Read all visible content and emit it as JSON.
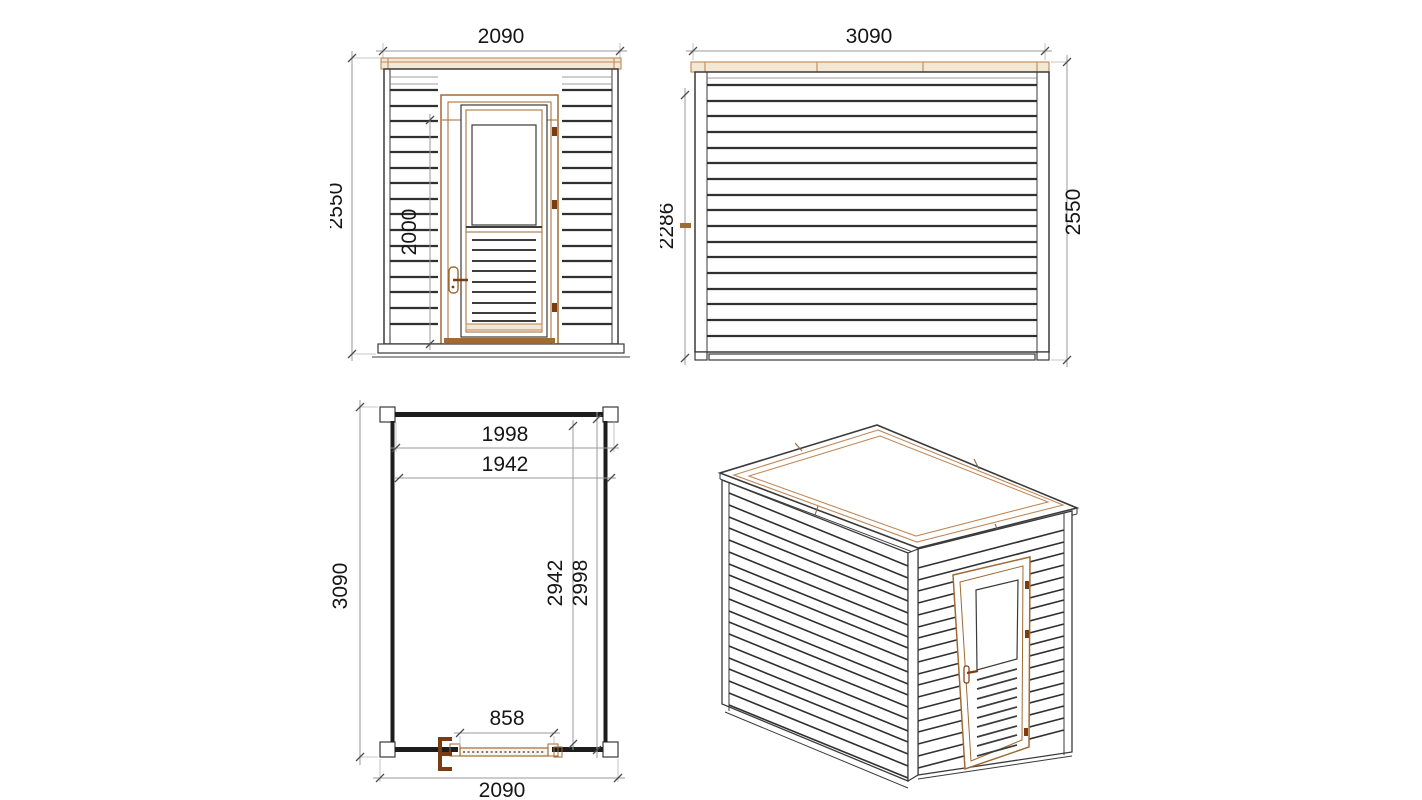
{
  "colors": {
    "line": "#3a3a3a",
    "dimension_line": "#9a9a9a",
    "label_text": "#161616",
    "wood_fill": "#f3e8d4",
    "wood_outline": "#c0895a",
    "door_frame": "#a06a33",
    "hinge": "#7a3c10",
    "background": "#ffffff"
  },
  "views": {
    "front": {
      "dims": {
        "width": "2090",
        "height": "2550",
        "door_height": "2000"
      }
    },
    "side": {
      "dims": {
        "width": "3090",
        "wall_height": "2286",
        "height": "2550"
      }
    },
    "plan": {
      "dims": {
        "inner_width_a": "1998",
        "inner_width_b": "1942",
        "length": "3090",
        "inner_length_a": "2942",
        "inner_length_b": "2998",
        "door_width": "858",
        "width": "2090"
      }
    },
    "iso": {}
  }
}
